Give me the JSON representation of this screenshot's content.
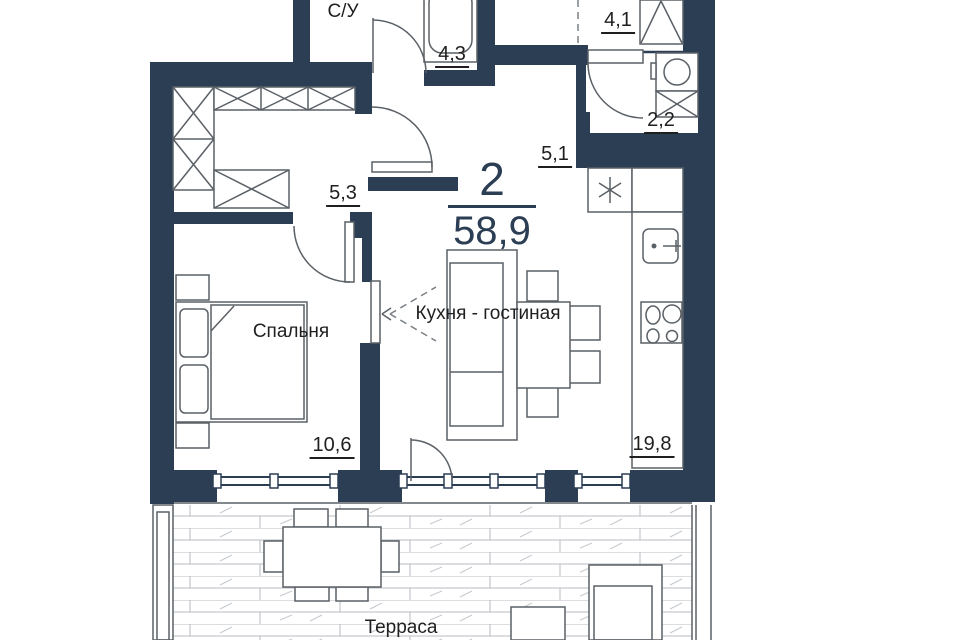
{
  "plan": {
    "unit": {
      "rooms_count": "2",
      "total_area": "58,9"
    },
    "rooms": {
      "bathroom": {
        "name": "С/У",
        "area": "4,3"
      },
      "entry": {
        "area": "4,1"
      },
      "laundry": {
        "area": "2,2"
      },
      "corridor": {
        "area": "5,1"
      },
      "hallway": {
        "area": "5,3"
      },
      "bedroom": {
        "name": "Спальня",
        "area": "10,6"
      },
      "kitchen_living": {
        "name": "Кухня - гостиная",
        "area": "19,8"
      },
      "terrace": {
        "name": "Терраса"
      }
    },
    "colors": {
      "wall": "#2b3e54",
      "line": "#5a6066",
      "plank": "#b7bbc0",
      "accent": "#2b3e54",
      "text": "#1f1f1f"
    }
  }
}
